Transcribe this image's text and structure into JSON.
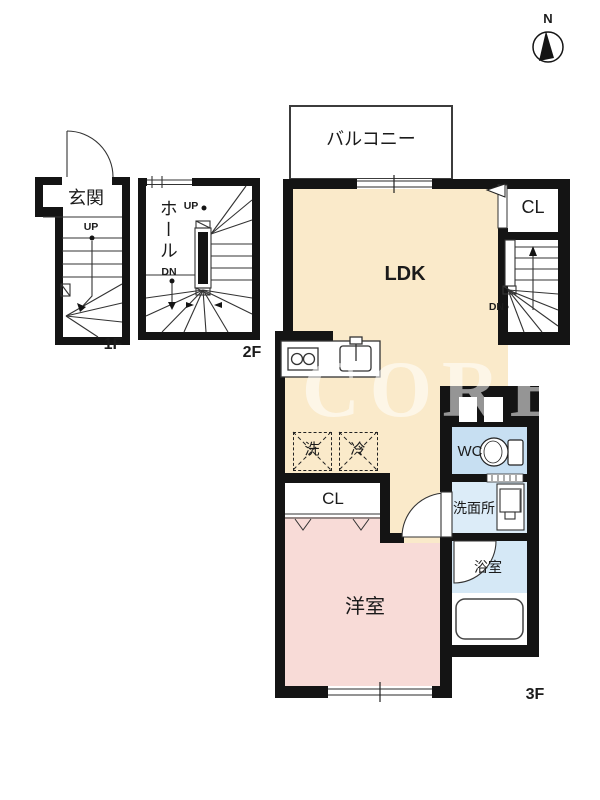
{
  "north": {
    "label": "N"
  },
  "watermark": {
    "text": "CORE"
  },
  "floor1": {
    "floor_label": "1F",
    "genkan": "玄関",
    "up": "UP"
  },
  "floor2": {
    "floor_label": "2F",
    "hall": "ホール",
    "up": "UP",
    "down": "DN"
  },
  "floor3": {
    "floor_label": "3F",
    "balcony": "バルコニー",
    "ldk": "LDK",
    "closet_upper": "CL",
    "closet_lower": "CL",
    "down": "DN",
    "washer": "洗",
    "fridge": "冷",
    "wc": "WC",
    "washroom": "洗面所",
    "bathroom": "浴室",
    "western_room": "洋室"
  },
  "colors": {
    "ldk_fill": "#faeaca",
    "room_fill": "#f8dbd7",
    "wc_fill": "#c7dff2",
    "washroom_fill": "#dcecf8",
    "bath_fill": "#d5e8f6",
    "wall": "#141414",
    "line": "#333333"
  }
}
